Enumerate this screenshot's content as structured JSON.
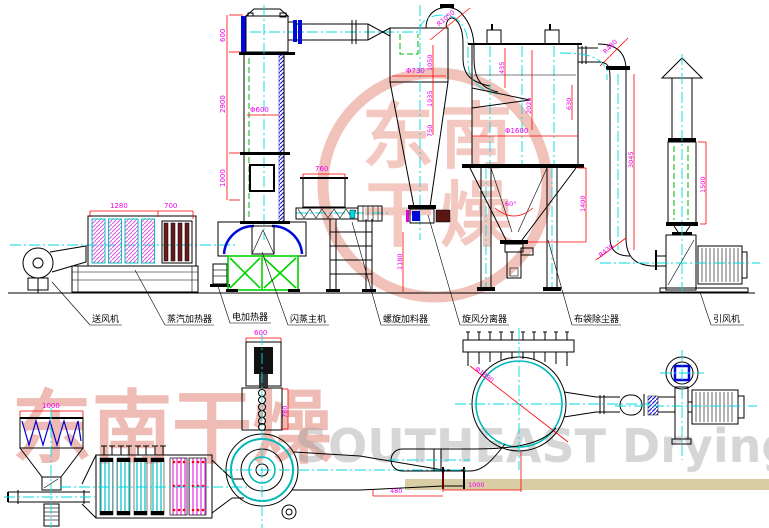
{
  "drawing": {
    "labels": {
      "blower": "送风机",
      "steam_heater": "蒸汽加热器",
      "electric_heater": "电加热器",
      "flash_dryer": "闪蒸主机",
      "screw_feeder": "螺旋加料器",
      "cyclone": "旋风分离器",
      "bag_filter": "布袋除尘器",
      "id_fan": "引风机"
    },
    "elev_dims": {
      "tower_cap": "600",
      "tower_body": "2900",
      "tower_base": "1000",
      "tower_dia": "Φ600",
      "heater_len": "1280",
      "heater_sec": "700",
      "feeder_width": "760",
      "cyclone_dia": "Φ730",
      "elbow_rad": "R1050",
      "cy_h1": "1050",
      "cy_h2": "1935",
      "cy_h3": "750",
      "cy_clear": "1180",
      "bag_inlet": "435",
      "bag_dia": "Φ1600",
      "bag_body": "2025",
      "bag_cone": "1400",
      "cone_angle": "60°",
      "out_elbow": "R480",
      "out_offset": "630",
      "out_drop": "3045",
      "fan_elbow": "R430",
      "silencer": "1500"
    },
    "plan_dims": {
      "hopper_w": "1000",
      "motor_w": "600",
      "feeder_l": "780",
      "duct_l": "480",
      "offset": "1000",
      "bag_dia": "Φ1890"
    }
  },
  "watermark": {
    "cn": "东南干燥",
    "en": "SOUTHEAST Drying",
    "seal": [
      "东",
      "南",
      "干",
      "燥"
    ]
  }
}
